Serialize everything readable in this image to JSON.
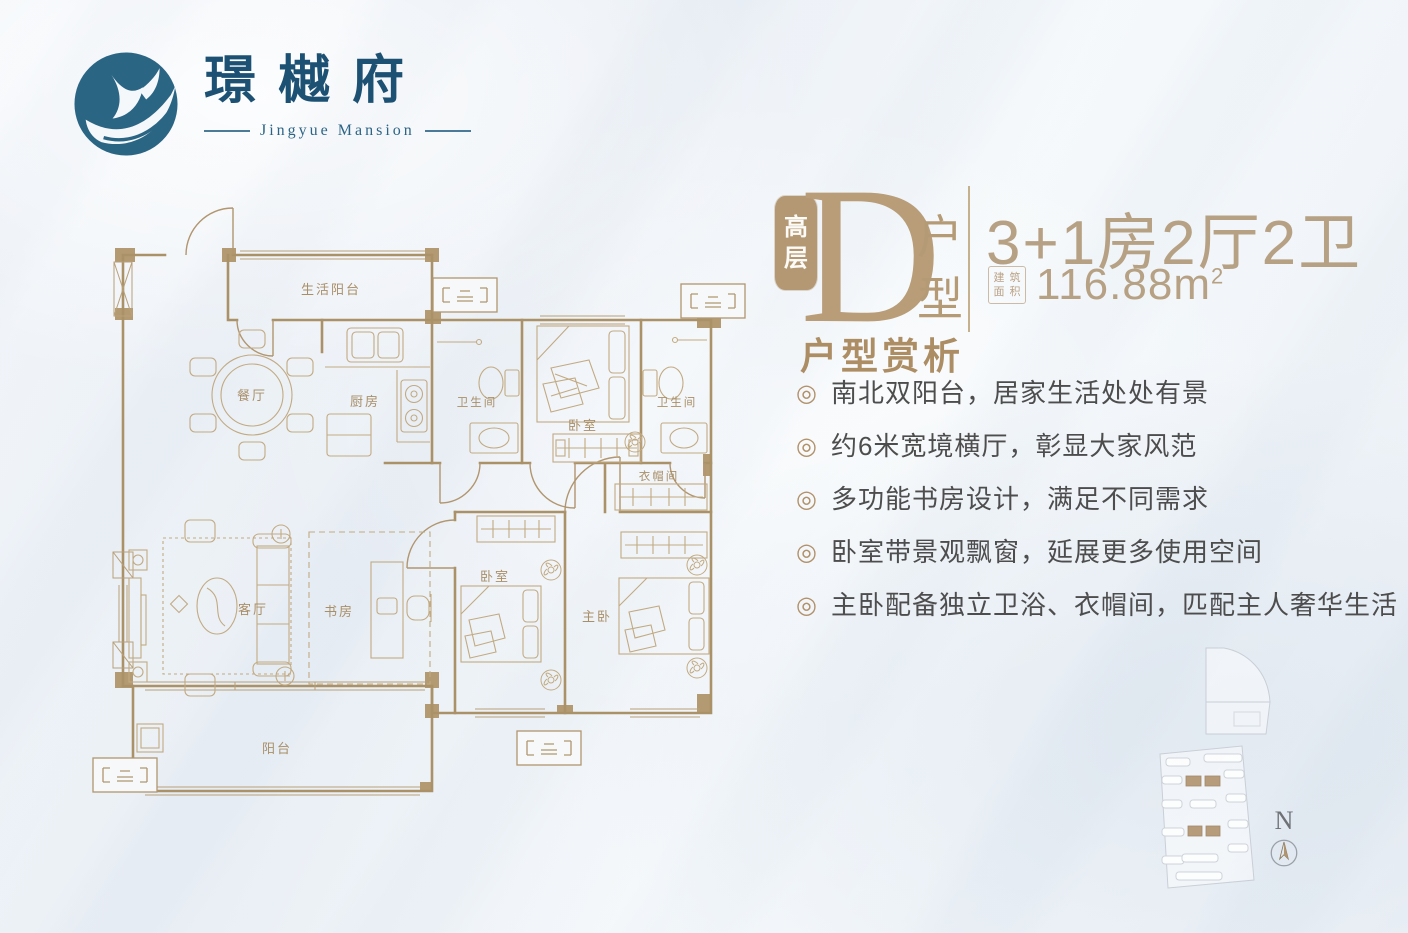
{
  "brand": {
    "name": "璟樾府",
    "subtitle": "Jingyue Mansion"
  },
  "unit": {
    "tier": [
      "高",
      "层"
    ],
    "letter": "D",
    "type": [
      "户",
      "型"
    ],
    "layout": "3+1房2厅2卫",
    "area_stamp": [
      "建",
      "筑",
      "面",
      "积"
    ],
    "area": "116.88m",
    "area_exp": "2"
  },
  "features": {
    "heading": "户型赏析",
    "bullet": "◎",
    "items": [
      "南北双阳台，居家生活处处有景",
      "约6米宽境横厅，彰显大家风范",
      "多功能书房设计，满足不同需求",
      "卧室带景观飘窗，延展更多使用空间",
      "主卧配备独立卫浴、衣帽间，匹配主人奢华生活"
    ]
  },
  "floorplan": {
    "rooms": [
      {
        "label": "生活阳台"
      },
      {
        "label": "餐厅"
      },
      {
        "label": "厨房"
      },
      {
        "label": "卫生间"
      },
      {
        "label": "卧室"
      },
      {
        "label": "卫生间"
      },
      {
        "label": "衣帽间"
      },
      {
        "label": "客厅"
      },
      {
        "label": "书房"
      },
      {
        "label": "卧室"
      },
      {
        "label": "主卧"
      },
      {
        "label": "阳台"
      }
    ]
  },
  "compass": {
    "label": "N"
  },
  "colors": {
    "accent": "#b1916a",
    "ink": "#1d5173",
    "text": "#4d4d4d",
    "wall": "#ab9168"
  }
}
